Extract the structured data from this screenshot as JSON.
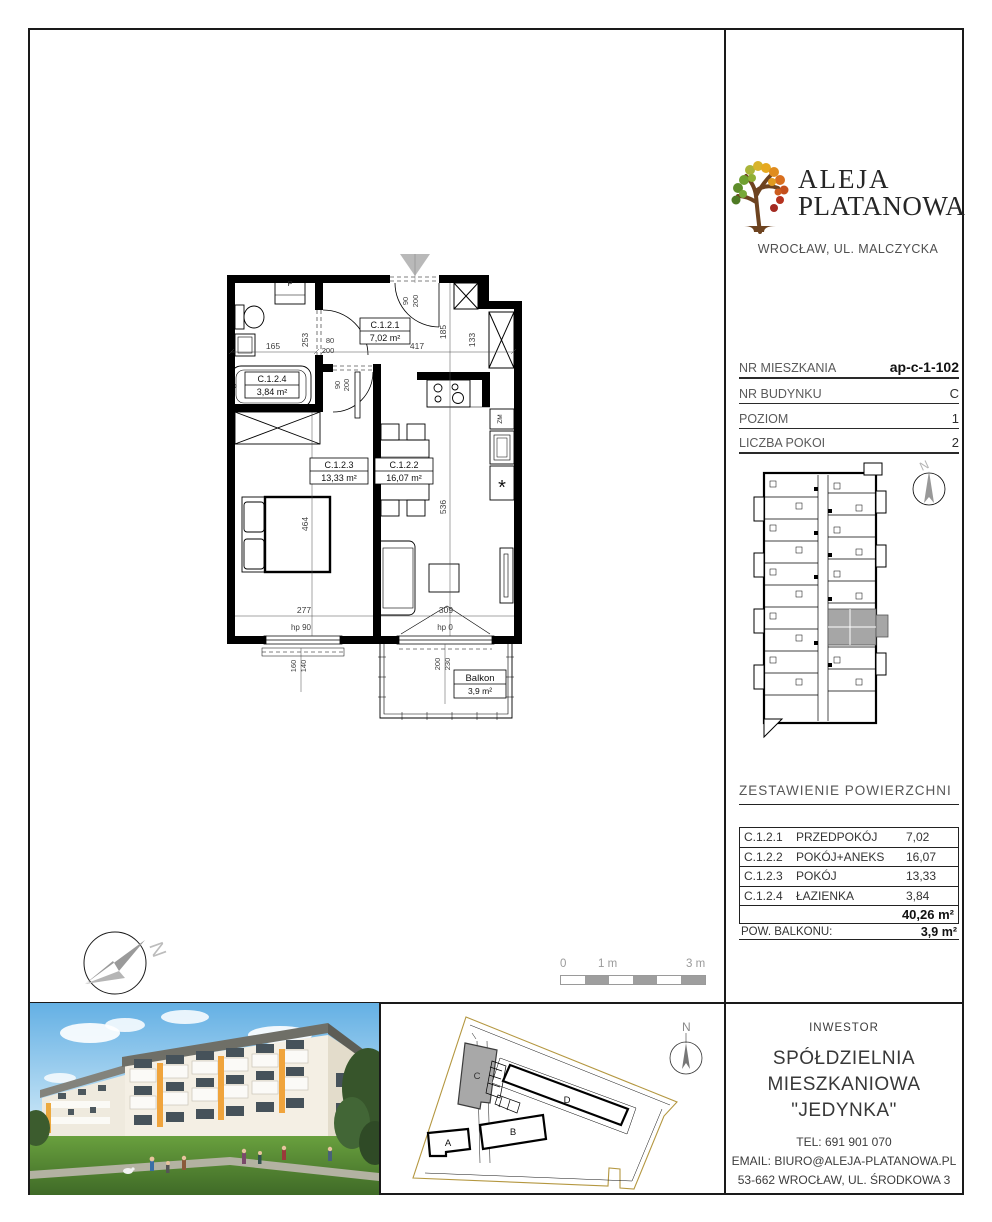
{
  "logo": {
    "line1": "ALEJA",
    "line2": "PLATANOWA",
    "location": "WROCŁAW, UL. MALCZYCKA"
  },
  "unit_info": {
    "rows": [
      {
        "label": "NR MIESZKANIA",
        "value": "ap-c-1-102"
      },
      {
        "label": "NR BUDYNKU",
        "value": "C"
      },
      {
        "label": "POZIOM",
        "value": "1"
      },
      {
        "label": "LICZBA POKOI",
        "value": "2"
      }
    ]
  },
  "floorplan": {
    "rooms": {
      "hall": {
        "code": "C.1.2.1",
        "area": "7,02 m²"
      },
      "living": {
        "code": "C.1.2.2",
        "area": "16,07 m²"
      },
      "bedroom": {
        "code": "C.1.2.3",
        "area": "13,33 m²"
      },
      "bath": {
        "code": "C.1.2.4",
        "area": "3,84 m²"
      }
    },
    "balcony": {
      "name": "Balkon",
      "area": "3,9 m²"
    },
    "dims": {
      "bath_width": "165",
      "bath_depth": "253",
      "bath_door_width": "80",
      "bath_door_height": "200",
      "hall_width": "417",
      "entry_door_width": "90",
      "entry_door_height": "200",
      "shaft_left": "185",
      "shaft_right": "133",
      "bed_door_width": "90",
      "bed_door_height": "200",
      "bedroom_depth": "464",
      "living_depth": "536",
      "bedroom_width": "277",
      "living_width": "309",
      "bedroom_window_hp": "hp 90",
      "balcony_door_hp": "hp 0",
      "bedroom_window_a": "160",
      "bedroom_window_b": "140",
      "balcony_door_a": "200",
      "balcony_door_b": "230"
    },
    "appliances": {
      "washer": "P",
      "dishwasher": "ZM",
      "fridge_mark": "*"
    }
  },
  "scalebar": {
    "zero": "0",
    "one": "1 m",
    "three": "3 m"
  },
  "compass": {
    "north": "N"
  },
  "areas": {
    "title": "ZESTAWIENIE POWIERZCHNI",
    "rows": [
      {
        "code": "C.1.2.1",
        "name": "PRZEDPOKÓJ",
        "value": "7,02"
      },
      {
        "code": "C.1.2.2",
        "name": "POKÓJ+ANEKS",
        "value": "16,07"
      },
      {
        "code": "C.1.2.3",
        "name": "POKÓJ",
        "value": "13,33"
      },
      {
        "code": "C.1.2.4",
        "name": "ŁAZIENKA",
        "value": "3,84"
      }
    ],
    "total": "40,26 m²",
    "balcony_label": "POW. BALKONU:",
    "balcony_value": "3,9 m²"
  },
  "siteplan": {
    "building_a": "A",
    "building_b": "B",
    "building_c": "C",
    "building_d": "D",
    "north": "N"
  },
  "footer": {
    "title": "INWESTOR",
    "name1": "SPÓŁDZIELNIA",
    "name2": "MIESZKANIOWA \"JEDYNKA\"",
    "tel": "TEL:  691 901 070",
    "email": "EMAIL: BIURO@ALEJA-PLATANOWA.PL",
    "address": "53-662 WROCŁAW, UL. ŚRODKOWA 3"
  },
  "colors": {
    "accent_orange": "#f0a43c",
    "site_boundary": "#b49740",
    "highlight_gray": "#a6a6a6",
    "entrance_marker": "#b9b9b9"
  }
}
